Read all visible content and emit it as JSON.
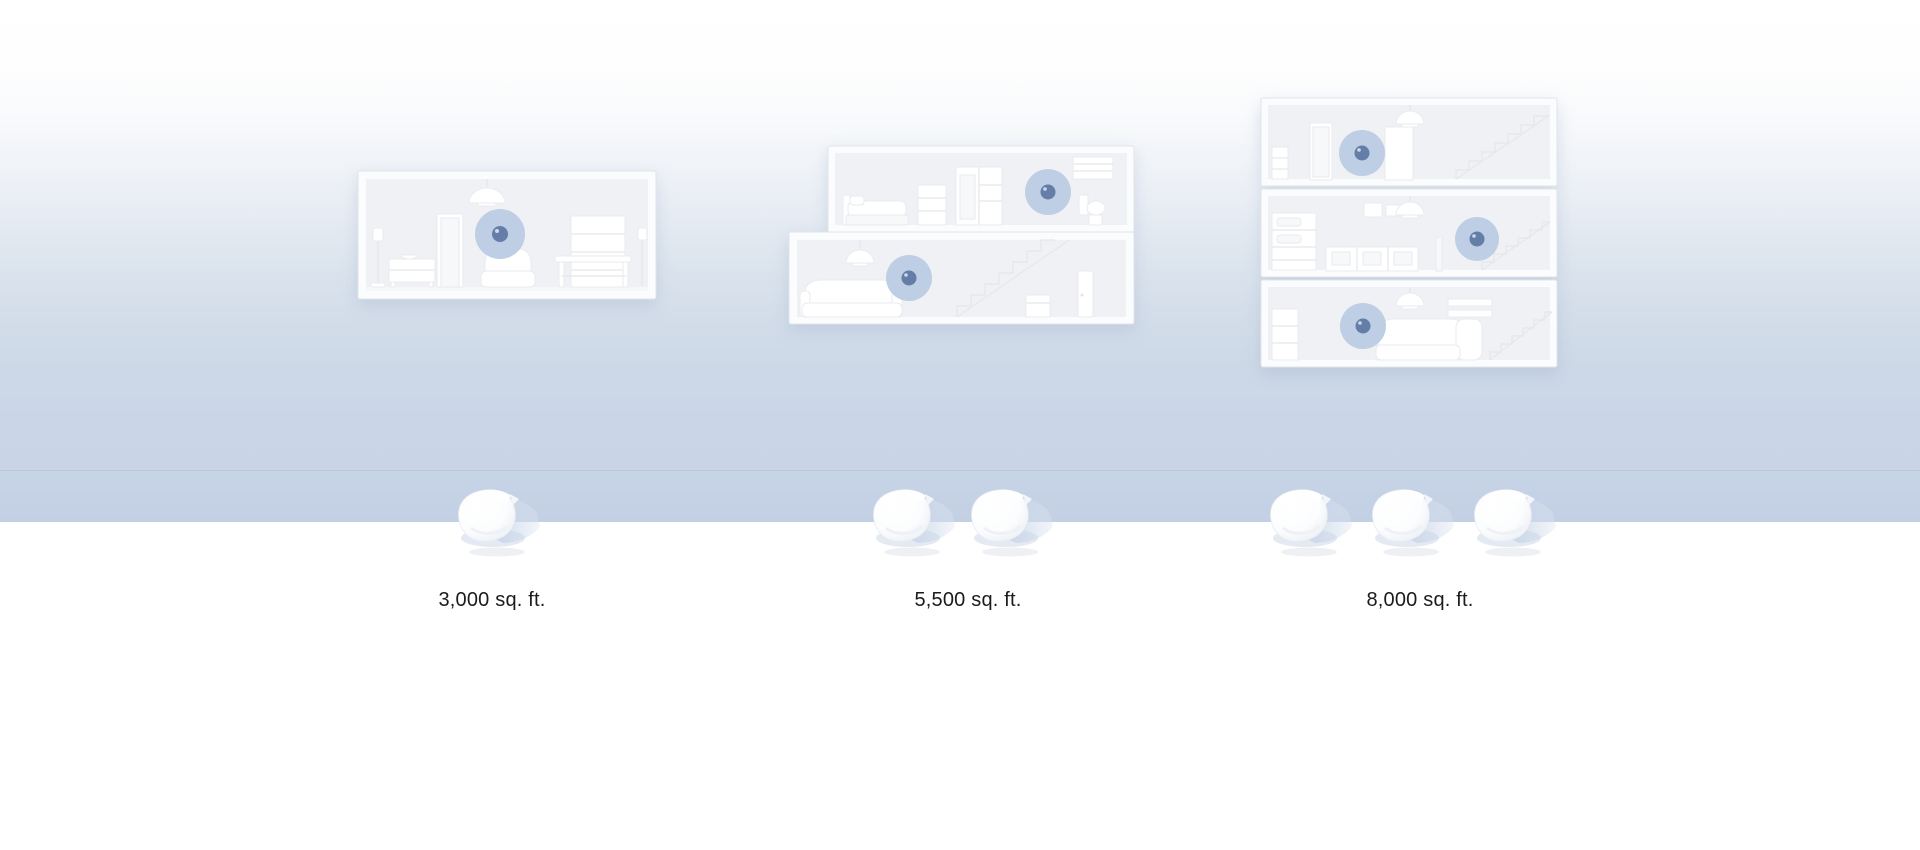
{
  "scene": {
    "description": "Wi-Fi mesh coverage comparison by home size",
    "items": [
      {
        "label": "3,000 sq. ft.",
        "floors": 1,
        "router_count": 1,
        "coverage_points": 1
      },
      {
        "label": "5,500 sq. ft.",
        "floors": 2,
        "router_count": 2,
        "coverage_points": 2
      },
      {
        "label": "8,000 sq. ft.",
        "floors": 3,
        "router_count": 3,
        "coverage_points": 3
      }
    ],
    "colors": {
      "coverage_circle": "#b9cbe3",
      "coverage_dot": "#647ea8",
      "floor_band": "#c5d2e5",
      "ground": "#ffffff",
      "label_text": "#1b1b1d"
    },
    "icons": {
      "router": "wifi-router",
      "coverage": "coverage-point"
    }
  }
}
